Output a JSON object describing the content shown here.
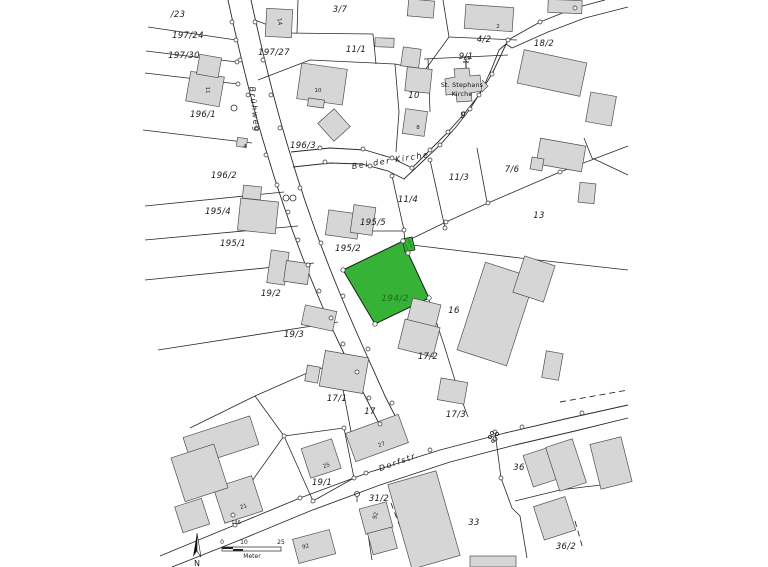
{
  "map": {
    "colors": {
      "background": "#ffffff",
      "line": "#2a2a2a",
      "building_fill": "#d6d6d6",
      "building_stroke": "#4f4f4f",
      "highlight_fill": "#36b336",
      "highlight_label": "#1f6b1f"
    },
    "highlighted_parcel": "194/2",
    "parcel_labels": [
      {
        "text": "/23",
        "x": 178,
        "y": 17
      },
      {
        "text": "197/24",
        "x": 188,
        "y": 38
      },
      {
        "text": "197/30",
        "x": 184,
        "y": 58
      },
      {
        "text": "197/27",
        "x": 274,
        "y": 55
      },
      {
        "text": "3/7",
        "x": 340,
        "y": 12
      },
      {
        "text": "11/1",
        "x": 356,
        "y": 52
      },
      {
        "text": "4/2",
        "x": 484,
        "y": 42
      },
      {
        "text": "9/1",
        "x": 466,
        "y": 59
      },
      {
        "text": "18/2",
        "x": 544,
        "y": 46
      },
      {
        "text": "196/1",
        "x": 203,
        "y": 117
      },
      {
        "text": "196/3",
        "x": 303,
        "y": 148
      },
      {
        "text": "10",
        "x": 414,
        "y": 98
      },
      {
        "text": "9",
        "x": 463,
        "y": 118
      },
      {
        "text": "196/2",
        "x": 224,
        "y": 178
      },
      {
        "text": "11/3",
        "x": 459,
        "y": 180
      },
      {
        "text": "7/6",
        "x": 512,
        "y": 172
      },
      {
        "text": "11/4",
        "x": 408,
        "y": 202
      },
      {
        "text": "13",
        "x": 539,
        "y": 218
      },
      {
        "text": "195/4",
        "x": 218,
        "y": 214
      },
      {
        "text": "195/5",
        "x": 373,
        "y": 225
      },
      {
        "text": "195/1",
        "x": 233,
        "y": 246
      },
      {
        "text": "195/2",
        "x": 348,
        "y": 251
      },
      {
        "text": "19/2",
        "x": 271,
        "y": 296
      },
      {
        "text": "16",
        "x": 454,
        "y": 313
      },
      {
        "text": "19/3",
        "x": 294,
        "y": 337
      },
      {
        "text": "17/2",
        "x": 428,
        "y": 359
      },
      {
        "text": "17/1",
        "x": 337,
        "y": 401
      },
      {
        "text": "17",
        "x": 370,
        "y": 414
      },
      {
        "text": "17/3",
        "x": 456,
        "y": 417
      },
      {
        "text": "19/1",
        "x": 322,
        "y": 485
      },
      {
        "text": "31/2",
        "x": 379,
        "y": 501
      },
      {
        "text": "36",
        "x": 519,
        "y": 470
      },
      {
        "text": "33",
        "x": 474,
        "y": 525
      },
      {
        "text": "36/2",
        "x": 566,
        "y": 549
      }
    ],
    "highlight_label": {
      "text": "194/2",
      "x": 395,
      "y": 301
    },
    "street_labels": [
      {
        "text": "Brühweg",
        "x": 252,
        "y": 110,
        "rot": 84
      },
      {
        "text": "Bei der Kirche",
        "x": 391,
        "y": 163,
        "rot": -9
      },
      {
        "text": "Dorfstr.",
        "x": 400,
        "y": 464,
        "rot": -20
      }
    ],
    "church_label": {
      "line1": "St. Stephans",
      "line2": "Kirche",
      "x": 462,
      "y1": 87,
      "y2": 96
    },
    "building_numbers": [
      {
        "text": "11",
        "x": 206,
        "y": 90,
        "rot": 90
      },
      {
        "text": "14",
        "x": 278,
        "y": 22,
        "rot": 80
      },
      {
        "text": "10",
        "x": 318,
        "y": 92
      },
      {
        "text": "4",
        "x": 245,
        "y": 148
      },
      {
        "text": "2",
        "x": 498,
        "y": 28
      },
      {
        "text": "8",
        "x": 418,
        "y": 129
      },
      {
        "text": "27",
        "x": 382,
        "y": 446,
        "rot": -20
      },
      {
        "text": "25",
        "x": 327,
        "y": 467,
        "rot": -18
      },
      {
        "text": "21",
        "x": 244,
        "y": 508,
        "rot": -18
      },
      {
        "text": "92",
        "x": 377,
        "y": 516,
        "rot": -75
      },
      {
        "text": "92",
        "x": 306,
        "y": 548,
        "rot": -15
      }
    ],
    "point_labels": [
      {
        "text": "65",
        "x": 467,
        "y": 60
      },
      {
        "text": "136",
        "x": 236,
        "y": 524
      }
    ],
    "scale_bar": {
      "tick0": "0",
      "tick1": "10",
      "tick2": "25",
      "unit": "Meter"
    },
    "north_label": "N"
  }
}
